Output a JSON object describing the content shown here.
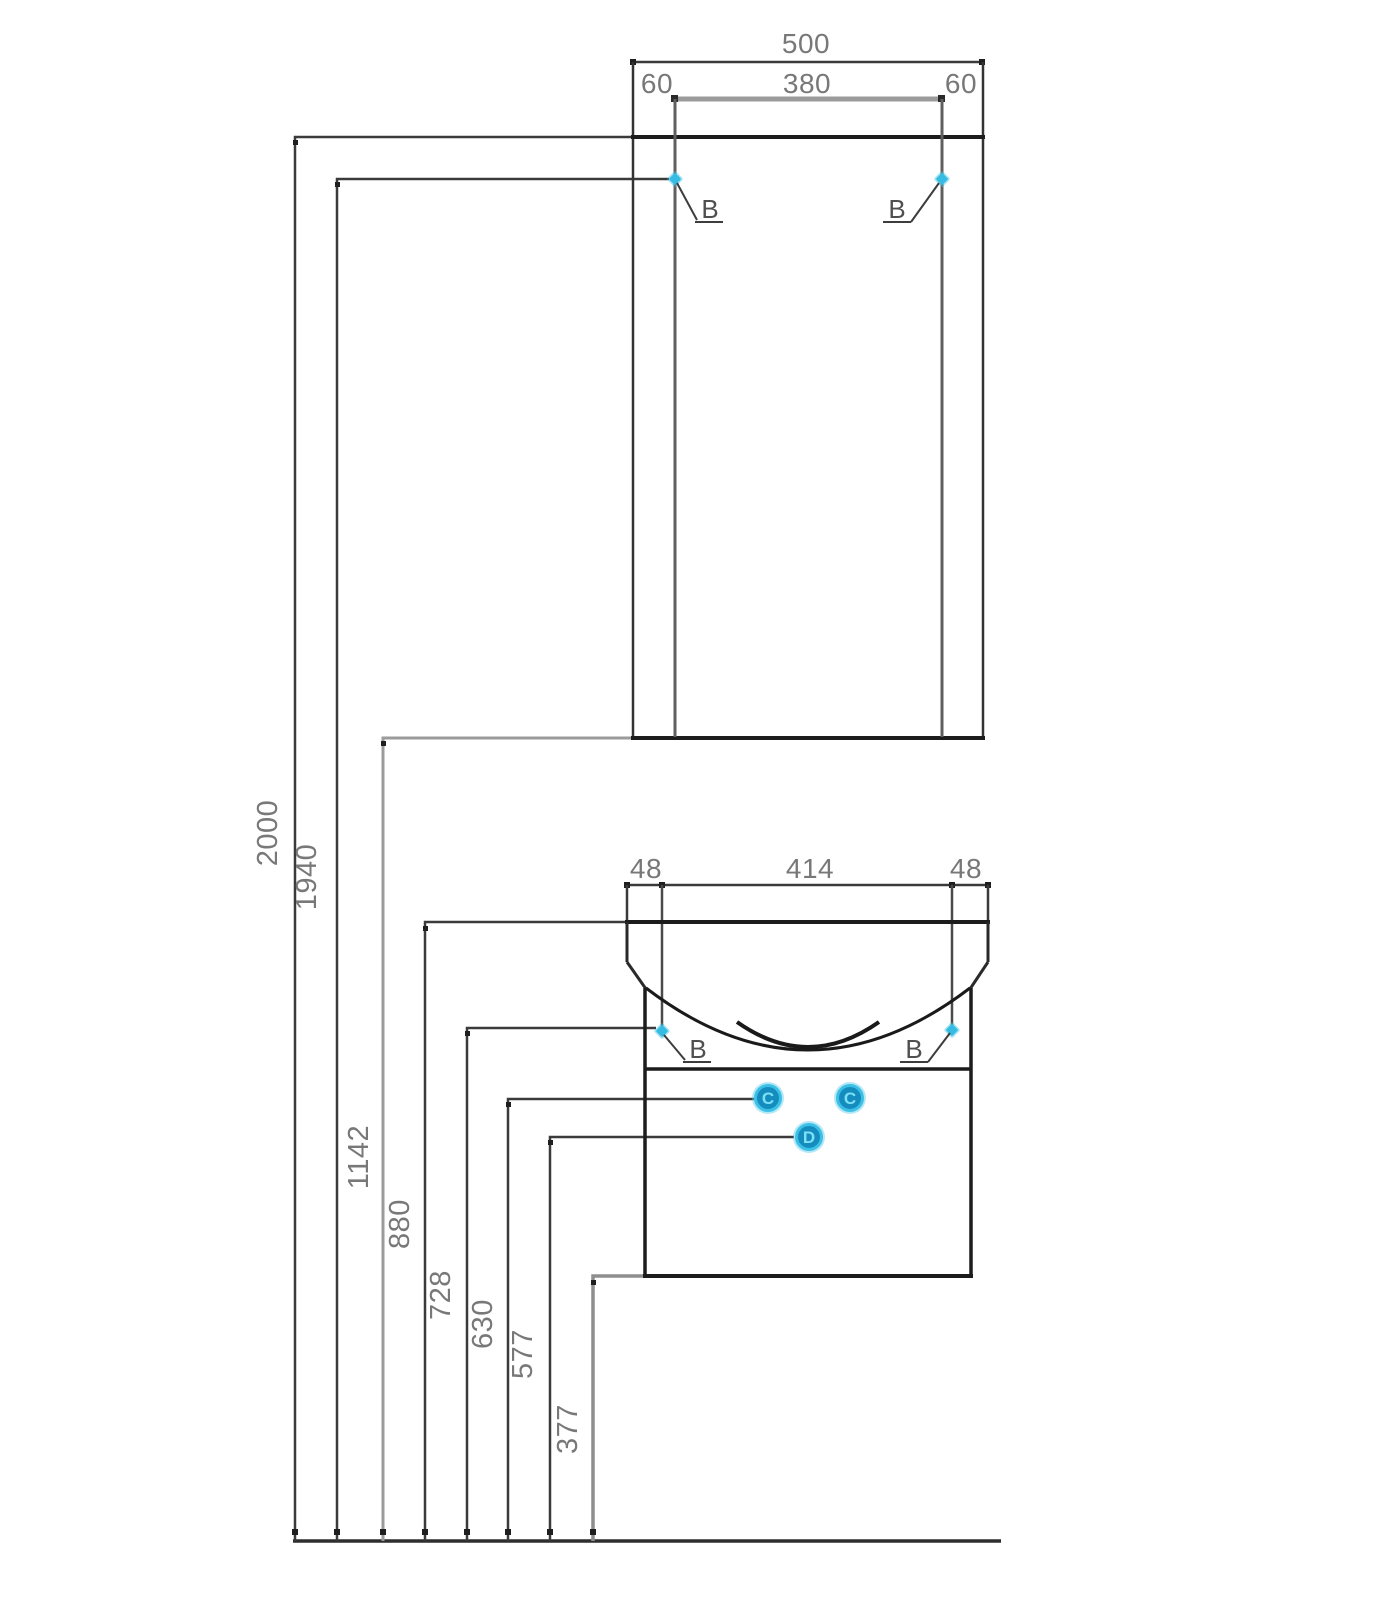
{
  "accent_color": "#3bbfe4",
  "mirror_cabinet": {
    "width_total": "500",
    "margin_left": "60",
    "door_width": "380",
    "margin_right": "60",
    "hinge_left": "B",
    "hinge_right": "B"
  },
  "washbasin_unit": {
    "margin_left": "48",
    "basin_width": "414",
    "margin_right": "48",
    "hinge_left": "B",
    "hinge_right": "B",
    "callouts": {
      "c_left": "C",
      "c_right": "C",
      "d": "D"
    }
  },
  "heights": {
    "total": "2000",
    "mirror_hinge": "1940",
    "mirror_bottom": "1142",
    "basin_top": "880",
    "basin_hinge": "728",
    "callout_c": "630",
    "callout_d": "577",
    "cabinet_bottom": "377"
  }
}
